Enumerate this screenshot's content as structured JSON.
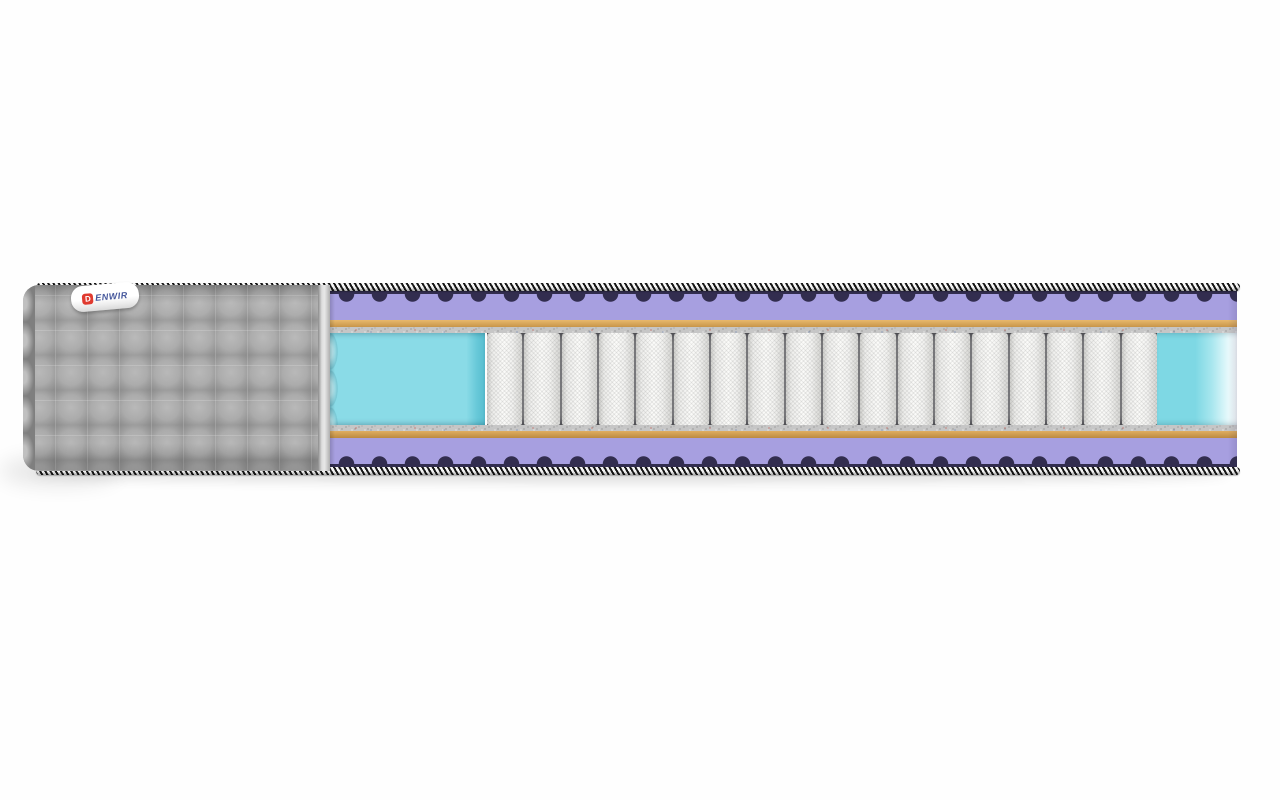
{
  "label": {
    "brand": "DENWIR",
    "logo_letter": "D",
    "text_after_logo": "ENWIR"
  },
  "mattress": {
    "parts": [
      "striped-piping-tape-top",
      "wave-contour-foam-top",
      "comfort-foam-top",
      "coir-layer-top",
      "felt-layer-top",
      "side-support-foam-left",
      "pocket-spring-block",
      "side-support-foam-right",
      "felt-layer-bottom",
      "coir-layer-bottom",
      "comfort-foam-bottom",
      "wave-contour-foam-bottom",
      "striped-piping-tape-bottom",
      "quilted-fabric-cover"
    ],
    "core": {
      "spring_count": 18
    }
  },
  "colors": {
    "foam_purple": "#a79fe0",
    "foam_purple_dark": "#322d4f",
    "coir_tan": "#d4a255",
    "felt_gray": "#c6c6c6",
    "foam_cyan": "#7ed8e4",
    "cover_gray": "#a4a4a4",
    "spring_white": "#f4f4f2",
    "piping_black": "#171717",
    "piping_white": "#f6f6f6",
    "label_red": "#e03a2f",
    "label_blue": "#44569b"
  }
}
